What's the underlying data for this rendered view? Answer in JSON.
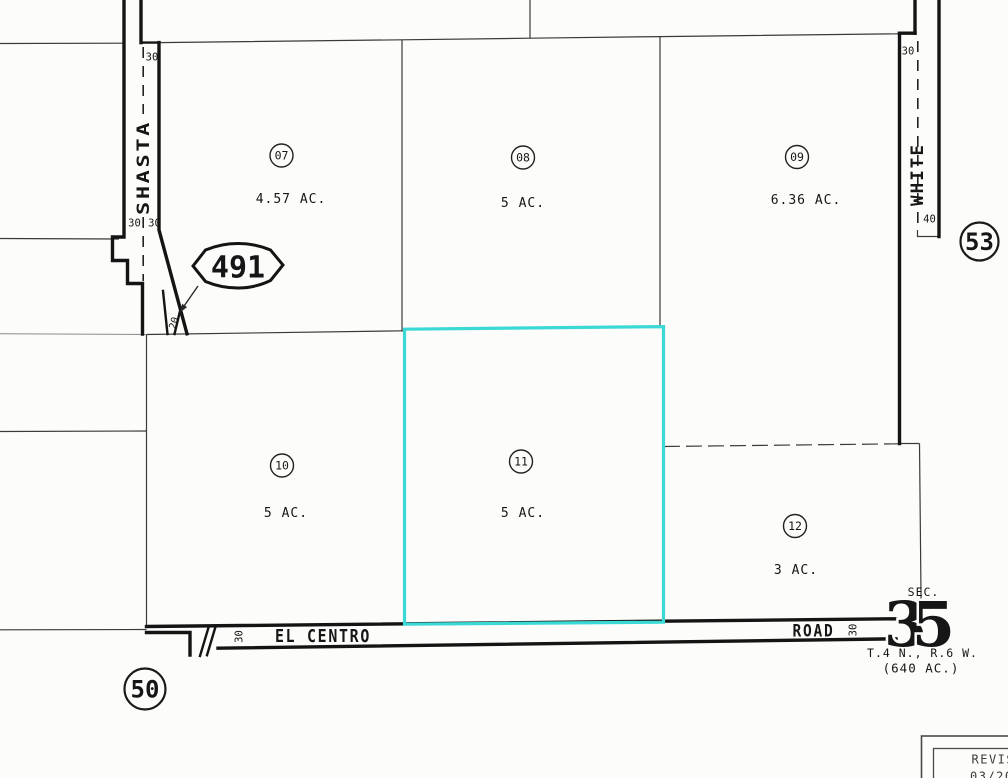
{
  "map": {
    "parcels": [
      {
        "number": "07",
        "acreage": "4.57 AC.",
        "highlighted": false
      },
      {
        "number": "08",
        "acreage": "5 AC.",
        "highlighted": false
      },
      {
        "number": "09",
        "acreage": "6.36 AC.",
        "highlighted": false
      },
      {
        "number": "10",
        "acreage": "5 AC.",
        "highlighted": false
      },
      {
        "number": "11",
        "acreage": "5 AC.",
        "highlighted": true
      },
      {
        "number": "12",
        "acreage": "3 AC.",
        "highlighted": false
      }
    ],
    "streets": {
      "shasta": "SHASTA",
      "white": "WHITE",
      "el_centro": "EL CENTRO",
      "road": "ROAD"
    },
    "references": {
      "route_491": "491",
      "sheet_53": "53",
      "sheet_50": "50"
    },
    "section": {
      "label": "SEC.",
      "digit_left": "3",
      "digit_right": "5",
      "township_range": "T.4 N., R.6 W.",
      "section_area": "(640 AC.)"
    },
    "dimensions": {
      "shasta_top": "30",
      "shasta_west": "30",
      "shasta_east": "30",
      "shasta_taper": "20",
      "white_top": "30",
      "white_south": "40",
      "el_centro_west": "30",
      "el_centro_east": "30"
    },
    "revision": {
      "label": "REVIS",
      "date": "03/20/"
    },
    "colors": {
      "highlight": "#3bd9d6",
      "line": "#1c1c1c"
    }
  }
}
